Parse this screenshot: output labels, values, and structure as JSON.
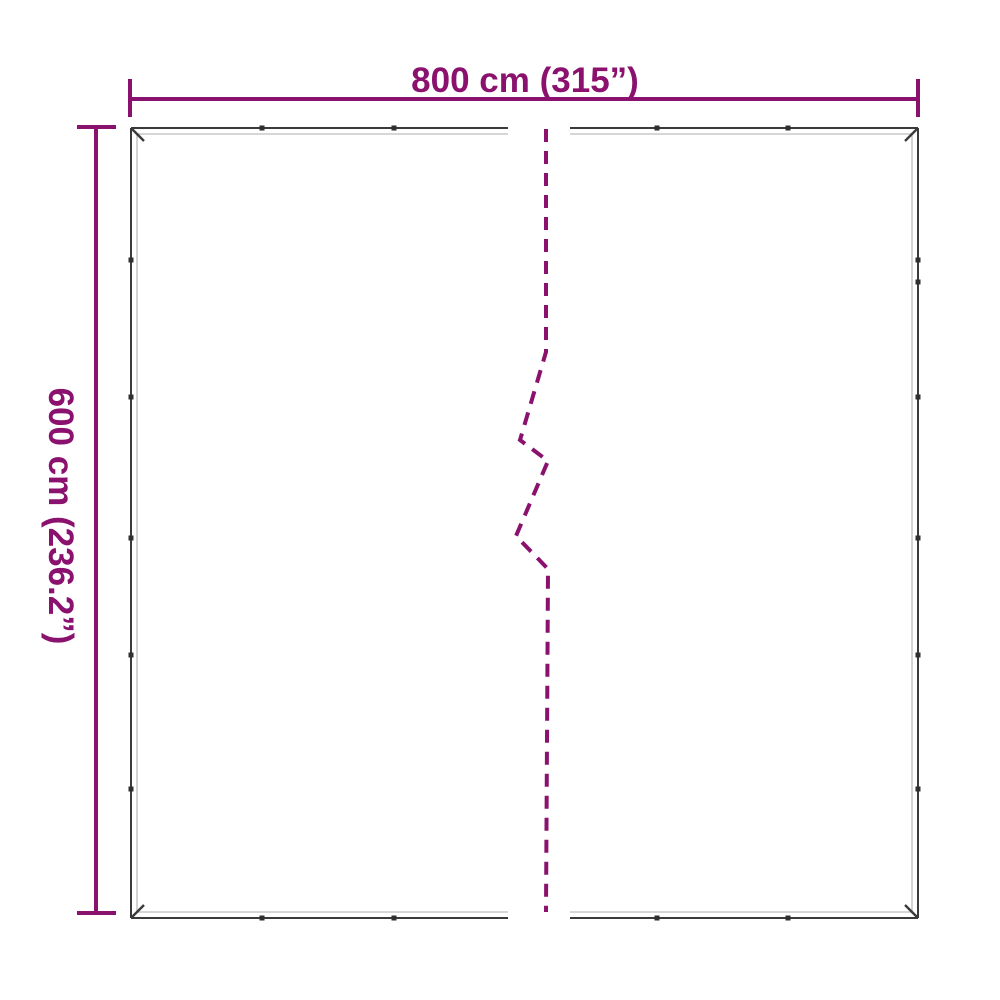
{
  "diagram": {
    "type": "product-dimension-diagram",
    "description": "Two-panel tarpaulin outline with grommets and a dashed center break line",
    "width_label": "800 cm (315”)",
    "height_label": "600 cm (236.2”)"
  },
  "colors": {
    "accent": "#8A116E",
    "outline": "#3A3A3A",
    "inner_hem": "#C8C8C8",
    "grommet": "#2F2F2F",
    "background": "#FFFFFF"
  }
}
